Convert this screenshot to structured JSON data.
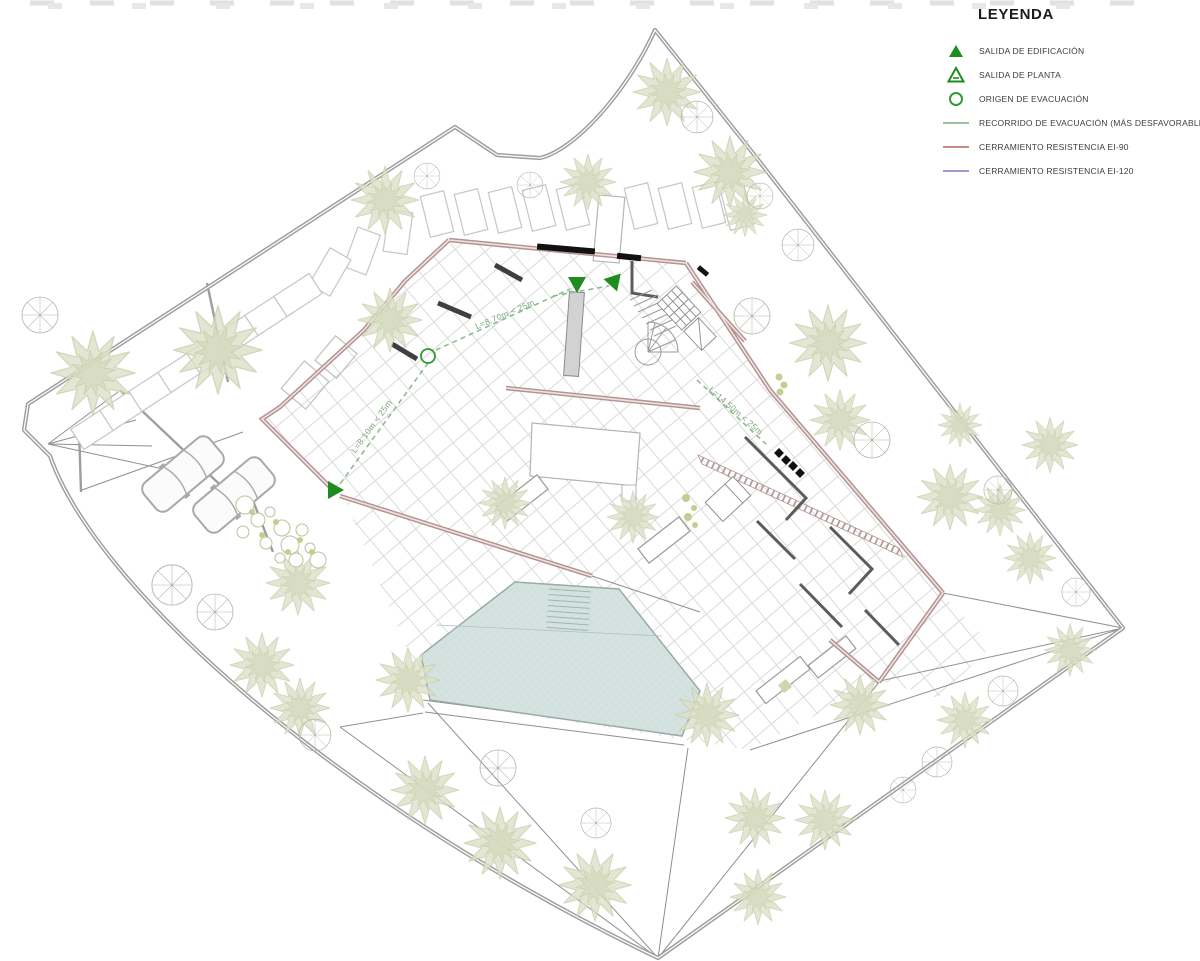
{
  "legend": {
    "title": "LEYENDA",
    "items": [
      {
        "id": "salida-edificacion",
        "symbol": "filled-green-triangle",
        "label": "SALIDA DE EDIFICACIÓN"
      },
      {
        "id": "salida-planta",
        "symbol": "outlined-green-triangle",
        "label": "SALIDA DE PLANTA"
      },
      {
        "id": "origen-evacuacion",
        "symbol": "green-circle-outline",
        "label": "ORIGEN DE EVACUACIÓN"
      },
      {
        "id": "recorrido-evacuacion",
        "symbol": "green-line",
        "label": "RECORRIDO DE EVACUACIÓN (MÁS DESFAVORABLE)"
      },
      {
        "id": "cerramiento-ei90",
        "symbol": "red-line",
        "label": "CERRAMIENTO RESISTENCIA EI-90"
      },
      {
        "id": "cerramiento-ei120",
        "symbol": "purple-line",
        "label": "CERRAMIENTO RESISTENCIA EI-120"
      }
    ]
  },
  "plan": {
    "route_labels": [
      {
        "text": "L=8.70m < 25m"
      },
      {
        "text": "L=8.10m < 25m"
      },
      {
        "text": "L=14.50m < 25m"
      }
    ],
    "markers": {
      "building_exit_triangles": 3,
      "evacuation_origin_circles": 1
    }
  },
  "colors": {
    "exit_green": "#1f8c1f",
    "route_green": "#8cbc8c",
    "ei90_red": "#c17a70",
    "ei120_purple": "#9d86cc",
    "wall_salmon": "#b29391",
    "boundary_gray": "#9e9e9e",
    "pool_blue": "#d5e3e0",
    "tree_olive": "#dde1c9"
  }
}
